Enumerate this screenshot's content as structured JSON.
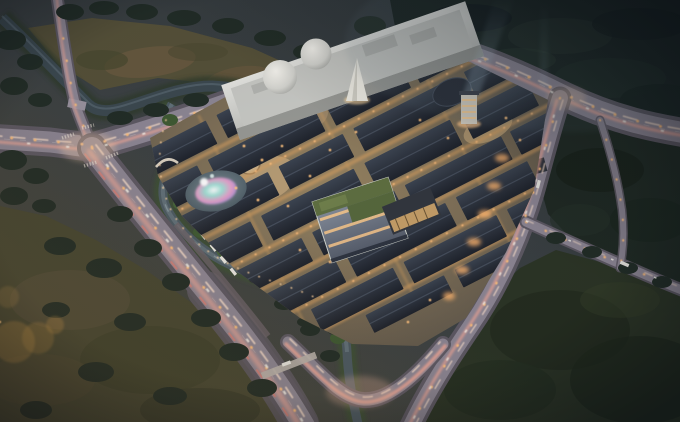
{
  "image": {
    "title": "Aerial dusk rendering of a mixed-use commercial district",
    "type": "architectural-rendering",
    "time_of_day": "dusk",
    "view": "oblique aerial bird's-eye view"
  },
  "palette": {
    "dusk_base": "#3a4146",
    "forest_deep": "#18221f",
    "forest_dark": "#222d27",
    "field_olive": "#545039",
    "field_brown": "#6e5c42",
    "field_bottom": "#434732",
    "field_dark_green": "#2c3526",
    "water": "#3c4950",
    "water_light": "#64747d",
    "road_dark": "#5e5964",
    "road_light": "#8d8694",
    "trail_pink": "#f2a899",
    "trail_white": "#ffe3cf",
    "trail_red": "#ff7a66",
    "lamp_warm": "#ffbf7d",
    "roof_dark": "#232831",
    "street_warm": "#cf9e63",
    "glow_warm": "#ffb469",
    "mall_white": "#d6d7d3",
    "dome_white": "#efeee9",
    "green_roof": "#5d6d40",
    "glass_cool": "#77808f",
    "fountain_teal": "#8fd8cf",
    "fountain_pink": "#e89fc6",
    "fountain_violet": "#a98fd6",
    "beam_blue": "#bcd8ea",
    "bokeh_gold": "#c9954a",
    "plaza_sand": "#b79c76"
  },
  "scene": {
    "regions": [
      {
        "id": "mall-building",
        "label": "White shopping mall with twin dome skylights"
      },
      {
        "id": "white-spire",
        "label": "White conical spire at mall entrance"
      },
      {
        "id": "lit-tower",
        "label": "Illuminated tower with searchlight beam"
      },
      {
        "id": "traditional-roof-district",
        "label": "Grid of dark traditional rooftops with warm lit lanes"
      },
      {
        "id": "green-roof-building",
        "label": "Modern glass building with rooftop garden"
      },
      {
        "id": "fountain-pond",
        "label": "Pond with iridescent fountain show"
      },
      {
        "id": "moat-canal",
        "label": "Winding canal around the district"
      },
      {
        "id": "north-canal",
        "label": "Canal bordering the north field"
      },
      {
        "id": "northwest-field",
        "label": "Open olive field"
      },
      {
        "id": "northeast-forest",
        "label": "Dark dusk forest"
      },
      {
        "id": "southwest-field",
        "label": "Meadow with tree clusters and golden lens bokeh"
      },
      {
        "id": "southeast-field",
        "label": "Dark wooded parcel"
      },
      {
        "id": "west-intersection",
        "label": "Lit crossroads with pink light trails"
      },
      {
        "id": "main-highway",
        "label": "Arterial road with traffic light trails"
      },
      {
        "id": "u-interchange",
        "label": "U-shaped interchange at the south edge"
      },
      {
        "id": "vehicles",
        "label": "Cars and buses on the roads"
      }
    ]
  }
}
